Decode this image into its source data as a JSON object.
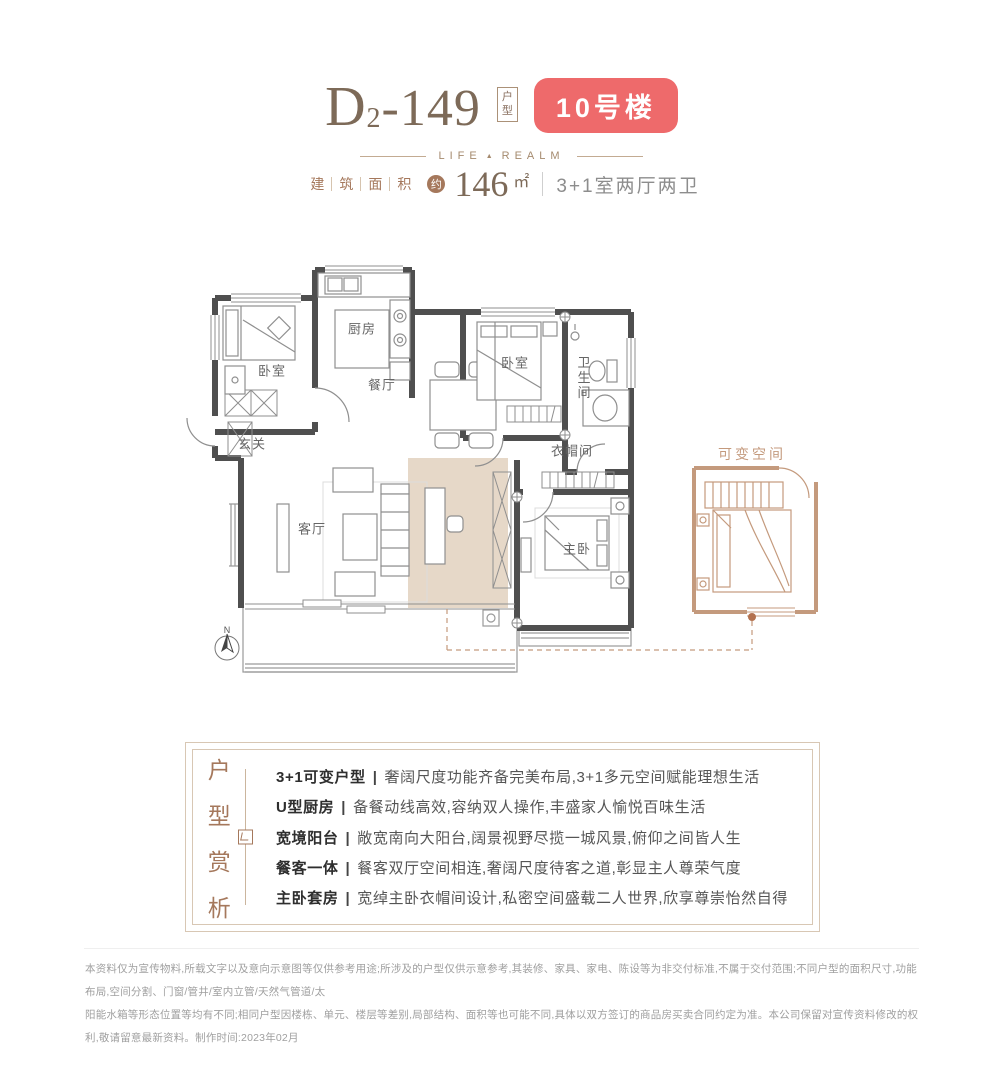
{
  "header": {
    "unit_type": {
      "letter": "D",
      "sub": "2",
      "rest": "-149"
    },
    "unit_type_tag": [
      "户",
      "型"
    ],
    "building_badge": "10号楼",
    "brand": {
      "left": "LIFE",
      "separator_icon": "▲",
      "right": "REALM"
    },
    "area": {
      "label_chars": [
        "建",
        "筑",
        "面",
        "积"
      ],
      "approx_char": "约",
      "value": "146",
      "unit": "㎡",
      "layout": "3+1室两厅两卫"
    }
  },
  "floorplan": {
    "labels": {
      "bedroom_north": "卧室",
      "kitchen": "厨房",
      "dining": "餐厅",
      "bedroom_east": "卧室",
      "bathroom": "卫生间",
      "entry": "玄关",
      "cloakroom": "衣帽间",
      "living": "客厅",
      "master": "主卧",
      "flexible_space": "可变空间",
      "compass_north": "N"
    },
    "colors": {
      "wall": "#4f4f4f",
      "furniture": "#8f8f8f",
      "highlight": "#e6d8c8",
      "flexible_outline": "#c49a7d"
    }
  },
  "features": {
    "vertical_title_chars": [
      "户",
      "型",
      "赏",
      "析"
    ],
    "separator": "|",
    "items": [
      {
        "title": "3+1可变户型",
        "desc": "奢阔尺度功能齐备完美布局,3+1多元空间赋能理想生活"
      },
      {
        "title": "U型厨房",
        "desc": "备餐动线高效,容纳双人操作,丰盛家人愉悦百味生活"
      },
      {
        "title": "宽境阳台",
        "desc": "敞宽南向大阳台,阔景视野尽揽一城风景,俯仰之间皆人生"
      },
      {
        "title": "餐客一体",
        "desc": "餐客双厅空间相连,奢阔尺度待客之道,彰显主人尊荣气度"
      },
      {
        "title": "主卧套房",
        "desc": "宽绰主卧衣帽间设计,私密空间盛载二人世界,欣享尊崇怡然自得"
      }
    ]
  },
  "footer": {
    "line1": "本资料仅为宣传物料,所载文字以及意向示意图等仅供参考用途;所涉及的户型仅供示意参考,其装修、家具、家电、陈设等为非交付标准,不属于交付范围;不同户型的面积尺寸,功能布局,空间分割、门窗/管井/室内立管/天然气管道/太",
    "line2": "阳能水箱等形态位置等均有不同;相同户型因楼栋、单元、楼层等差别,局部结构、面积等也可能不同,具体以双方签订的商品房买卖合同约定为准。本公司保留对宣传资料修改的权利,敬请留意最新资料。制作时间:2023年02月"
  },
  "colors": {
    "badge_bg": "#ee6a6b",
    "accent_brown": "#a5785c",
    "title_brown": "#7d6a58"
  }
}
